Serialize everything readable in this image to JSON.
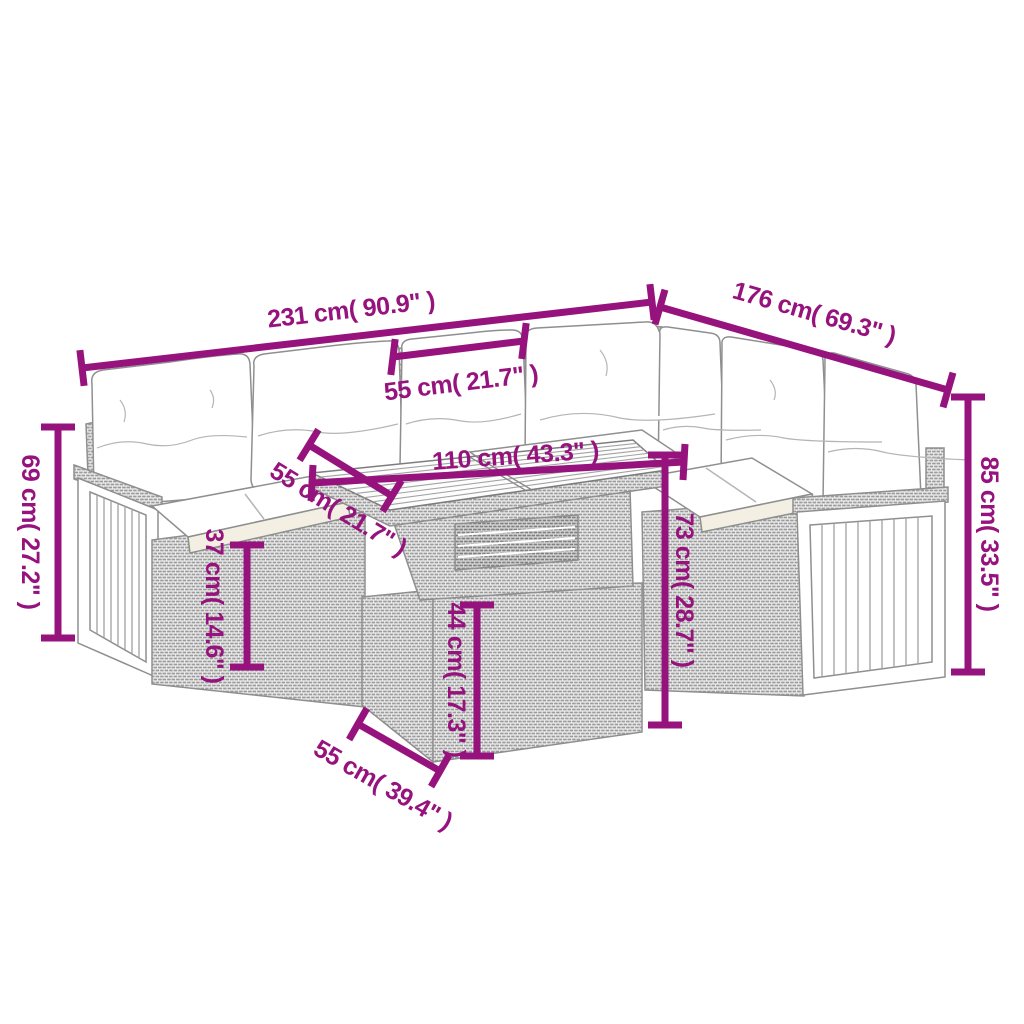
{
  "diagram": {
    "description": "7-piece rattan garden corner sofa set with cushions and slatted-top table, dimension drawing",
    "accent_color": "#96127d",
    "art_line_color": "#8f8f8f",
    "background_color": "#ffffff",
    "dims": {
      "total_width": "231 cm( 90.9\" )",
      "right_depth": "176 cm( 69.3\" )",
      "seat_width": "55 cm( 21.7\" )",
      "arm_height": "69 cm( 27.2\" )",
      "back_height": "85 cm( 33.5\" )",
      "seat_height": "37 cm( 14.6\" )",
      "table_lower_height": "44 cm( 17.3\" )",
      "table_height": "73 cm( 28.7\" )",
      "table_length": "110 cm( 43.3\" )",
      "table_depth": "55 cm( 21.7\" )",
      "table_bottom_depth": "55 cm( 39.4\" )"
    }
  }
}
